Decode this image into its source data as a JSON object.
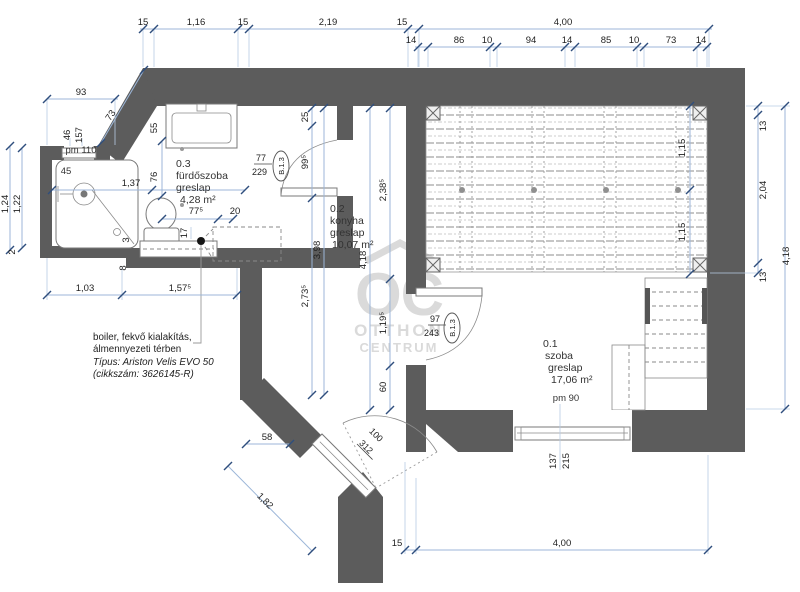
{
  "colors": {
    "wall": "#5c5c5c",
    "dim_line": "#9cb6d8",
    "tick": "#2f4e7d",
    "text": "#1f1f1f",
    "watermark": "#dadada"
  },
  "watermark": {
    "initials": "OC",
    "line1": "OTTHON",
    "line2": "CENTRUM"
  },
  "rooms": {
    "bathroom": {
      "number": "0.3",
      "name": "fürdőszoba",
      "finish": "greslap",
      "area": "4,28 m²"
    },
    "kitchen": {
      "number": "0.2",
      "name": "konyha",
      "finish": "greslap",
      "area": "10,07 m²"
    },
    "living": {
      "number": "0.1",
      "name": "szoba",
      "finish": "greslap",
      "area": "17,06 m²",
      "parapet": "pm 90"
    }
  },
  "shower": {
    "parapet": "pm 110",
    "dim45": "45"
  },
  "doors": {
    "bathroom": {
      "code": "B.1.3",
      "width": "77",
      "height": "229"
    },
    "living": {
      "code": "B.1.3",
      "width": "97",
      "height": "243"
    },
    "entry": {
      "width": "100",
      "height": "312"
    }
  },
  "window": {
    "width": "137",
    "height": "215"
  },
  "note": {
    "line1": "boiler, fekvő kialakítás,",
    "line2": "álmennyezeti térben",
    "line3": "Típus: Ariston Velis EVO 50",
    "line4": "(cikkszám: 3626145-R)"
  },
  "dims": {
    "top1": [
      "15",
      "1,16",
      "15",
      "2,19",
      "15",
      "4,00"
    ],
    "top2": [
      "14",
      "86",
      "10",
      "94",
      "14",
      "85",
      "10",
      "73",
      "14"
    ],
    "left": {
      "w93": "93",
      "w73": "73",
      "w46": "46",
      "w157": "157",
      "h124": "1,24",
      "h122": "1,22",
      "h2": "2",
      "w137": "1,37",
      "h55": "55",
      "h76": "76",
      "w775": "77⁵",
      "w20": "20",
      "h17": "17",
      "w3": "3",
      "h8": "8",
      "w103": "1,03",
      "w1575": "1,57⁵"
    },
    "kitchen": {
      "h25": "25",
      "h995": "99⁵",
      "h2735": "2,73⁵",
      "h398": "3,98",
      "h2385": "2,38⁵",
      "h1195": "1,19⁵",
      "h60": "60",
      "h418": "4,18"
    },
    "bottom": {
      "w58": "58",
      "d182": "1,82",
      "w15": "15",
      "w400": "4,00"
    },
    "right": {
      "h13a": "13",
      "h204": "2,04",
      "h13b": "13",
      "h418": "4,18"
    },
    "gallery": {
      "h115a": "1,15",
      "h115b": "1,15"
    }
  }
}
